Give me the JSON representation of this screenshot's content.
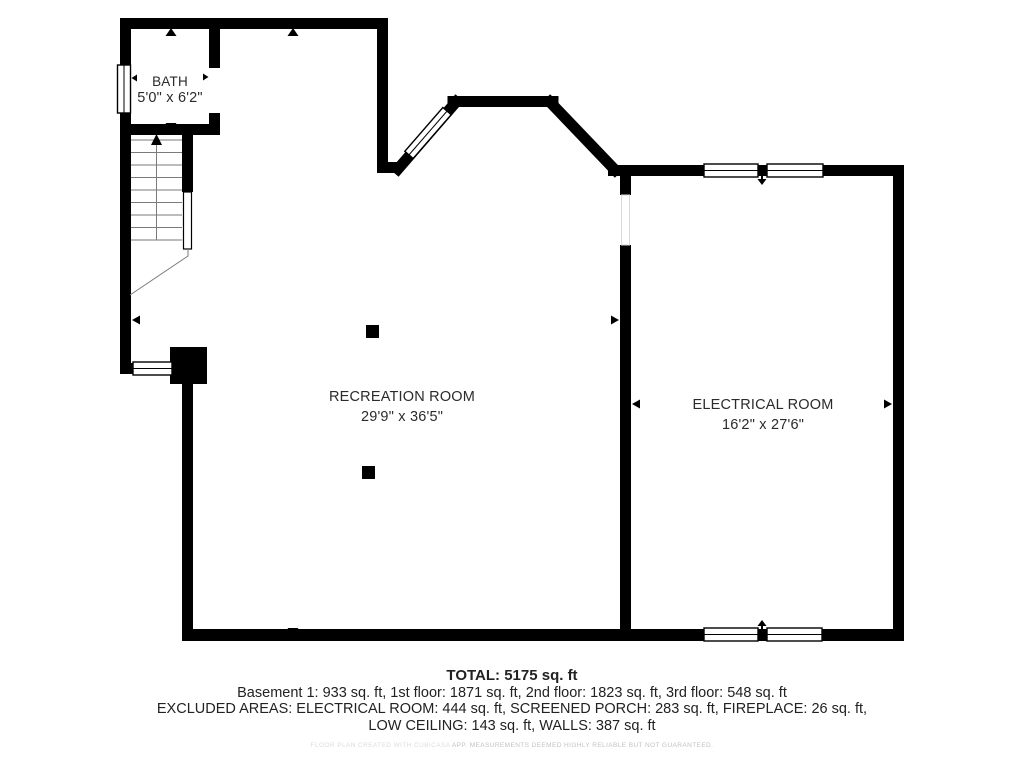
{
  "floorplan": {
    "rooms": {
      "bath": {
        "name": "BATH",
        "dims": "5'0\" x 6'2\""
      },
      "recreation": {
        "name": "RECREATION ROOM",
        "dims": "29'9\" x 36'5\""
      },
      "electrical": {
        "name": "ELECTRICAL ROOM",
        "dims": "16'2\" x 27'6\""
      }
    },
    "summary": {
      "total": "TOTAL: 5175 sq. ft",
      "floors": "Basement 1: 933 sq. ft, 1st floor: 1871 sq. ft, 2nd floor: 1823 sq. ft, 3rd floor: 548 sq. ft",
      "excluded1": "EXCLUDED AREAS: ELECTRICAL ROOM: 444 sq. ft, SCREENED PORCH: 283 sq. ft, FIREPLACE: 26 sq. ft,",
      "excluded2": "LOW CEILING: 143 sq. ft, WALLS: 387 sq. ft"
    },
    "disclaimer": {
      "prefix": "FLOOR PLAN CREATED WITH CUBICASA",
      "suffix": " APP. MEASUREMENTS DEEMED HIGHLY RELIABLE BUT NOT GUARANTEED."
    },
    "colors": {
      "wall": "#000000",
      "text": "#2b2b2b",
      "stair_line": "#7a7a7a",
      "watermark": "#c4c4c4"
    }
  }
}
